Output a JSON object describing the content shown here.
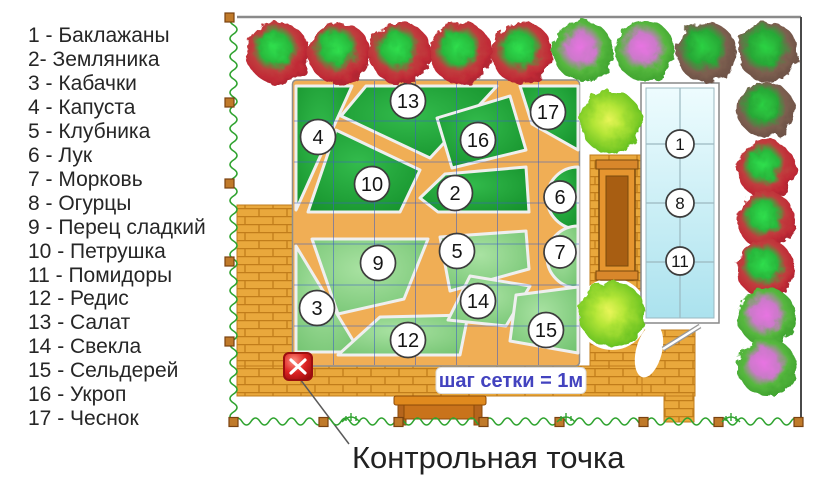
{
  "legend": {
    "items": [
      "1 - Баклажаны",
      "2- Земляника",
      "3 - Кабачки",
      "4 - Капуста",
      "5 - Клубника",
      "6 - Лук",
      "7 - Морковь",
      "8 - Огурцы",
      "9 - Перец сладкий",
      "10 - Петрушка",
      "11 - Помидоры",
      "12 - Редис",
      "13 - Салат",
      "14 - Свекла",
      "15 - Сельдерей",
      "16 - Укроп",
      "17 - Чеснок"
    ]
  },
  "plan": {
    "bed_labels": [
      "1",
      "2",
      "3",
      "4",
      "5",
      "6",
      "7",
      "8",
      "9",
      "10",
      "11",
      "12",
      "13",
      "14",
      "15",
      "16",
      "17"
    ],
    "grid_note": "шаг сетки = 1м",
    "control_point_label": "Контрольная точка",
    "colors": {
      "bed_dark_green": "#1b9c33",
      "bed_light_green": "#8bd488",
      "path_orange": "#f0ae55",
      "brick_orange": "#e9a83c",
      "greenhouse_cyan": "#cdeef7",
      "grid_blue": "#3e5ec4",
      "fence_green": "#2fa32f",
      "control_point_red": "#d01818",
      "note_text_blue": "#4343bf",
      "tree_red_edge": "#c12a36",
      "tree_brown_edge": "#6b5045",
      "tree_pink_center": "#e873e2",
      "bush_light_green": "#b4e637"
    }
  }
}
